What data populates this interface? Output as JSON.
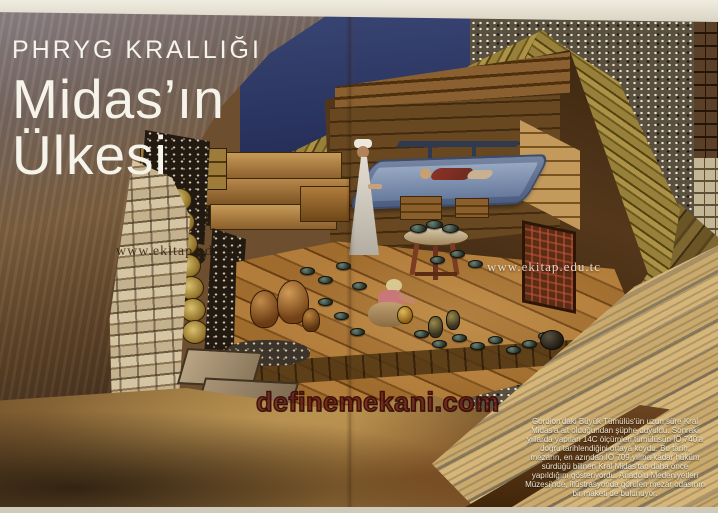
{
  "header": {
    "kicker": "PHRYG KRALLIĞI",
    "title_line1": "Midas’ın",
    "title_line2": "Ülkesi"
  },
  "watermarks": {
    "left_text": "www.ekitap.edu.tc",
    "right_text": "www.ekitap.edu.tc",
    "site_stamp": "definemekani.com"
  },
  "caption": {
    "lines": [
      "Gordion'daki Büyük Tümülüs'ün uzun süre Kral",
      "Midas'a ait olduğundan şüphe duyuldu. Sonraki",
      "yıllarda yapılan 14C ölçümleri tümülüsün İÖ 740'a",
      "doğru tarihlendiğini ortaya koydu. Bu tarih,",
      "mezarın, en azından İÖ 709 yılına kadar hüküm",
      "sürdüğü bilinen Kral Midas'tan daha önce",
      "yapıldığını gösteriyordu. Anadolu Medeniyetleri",
      "Müzesi'nde, illüstrasyonda görülen mezar odasının",
      "bir maketi de bulunuyor."
    ]
  },
  "scene": {
    "elements": [
      "mountain-slope",
      "stone-retaining-wall",
      "rubble-fill",
      "log-roof",
      "burial-chamber",
      "funeral-bed",
      "king-body",
      "standing-attendant",
      "kneeling-attendant",
      "bronze-bowls",
      "pottery-jars",
      "inlaid-table",
      "inlaid-screen",
      "cauldron",
      "stone-paving",
      "timber-beams"
    ],
    "colors": {
      "sky_blue": "#333e6b",
      "paper_edge": "#e9e5d8",
      "log_gold": "#9c8038",
      "floor_brown": "#a06c2e",
      "stamp_red": "#761e18",
      "caption_text": "#efe8d6",
      "title_text": "#f5f3ea"
    }
  }
}
